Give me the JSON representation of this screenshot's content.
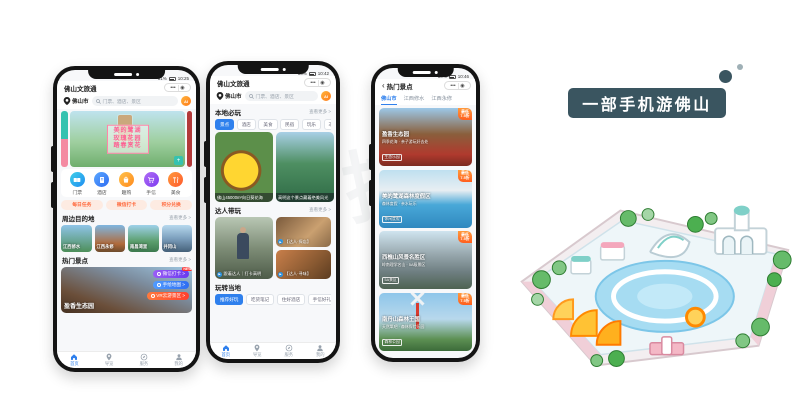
{
  "banner": {
    "title": "一部手机游佛山"
  },
  "watermark": "科技",
  "common": {
    "app_title": "佛山文旅通",
    "city": "佛山市",
    "search_placeholder": "门票、酒店、景区",
    "capsule_dots": "•••",
    "capsule_circle": "◉",
    "ai_label": "AI",
    "more_label": "查看更多 >"
  },
  "tabbar": {
    "items": [
      {
        "label": "首页"
      },
      {
        "label": "导览"
      },
      {
        "label": "服务"
      },
      {
        "label": "我的"
      }
    ]
  },
  "phone1": {
    "status_battery": "81%",
    "status_time": "10:25",
    "hero": {
      "line1": "美的鹭湖",
      "line2": "玫瑰花园",
      "line3": "踏春赏花",
      "plus": "+"
    },
    "quick_actions": [
      {
        "label": "门票"
      },
      {
        "label": "酒店"
      },
      {
        "label": "趣购"
      },
      {
        "label": "手信"
      },
      {
        "label": "美食"
      }
    ],
    "promos": [
      {
        "label": "每日任务"
      },
      {
        "label": "微信打卡"
      },
      {
        "label": "积分兑换"
      }
    ],
    "nearby": {
      "title": "周边目的地",
      "cards": [
        {
          "label": "江西修水"
        },
        {
          "label": "江西永修"
        },
        {
          "label": "南昌湾里"
        },
        {
          "label": "井冈山"
        }
      ]
    },
    "hot": {
      "title": "热门景点"
    },
    "feature": {
      "name": "盈香生态园",
      "badge1": "微信打卡 >",
      "badge1_tag": "NEW",
      "badge2": "手绘地图 >",
      "badge3": "VR云游景区 >"
    }
  },
  "phone2": {
    "status_battery": "80%",
    "status_time": "10:42",
    "must_play": {
      "title": "本地必玩",
      "chips": [
        {
          "label": "景点"
        },
        {
          "label": "酒店"
        },
        {
          "label": "美食"
        },
        {
          "label": "民宿"
        },
        {
          "label": "玩乐"
        },
        {
          "label": "非遗手作"
        }
      ],
      "card1_caption": "佛山45000m²向日葵花海",
      "card2_caption": "高明这个景点藏着绝美风光"
    },
    "daren": {
      "title": "达人带玩",
      "card1_caption": "跟着达人｜打卡高明",
      "card2_caption": "【达人·探店】",
      "card3_caption": "【达人·寻味】",
      "play": "▶"
    },
    "local": {
      "title": "玩转当地",
      "chips": [
        {
          "label": "推荐好玩"
        },
        {
          "label": "吃货笔记"
        },
        {
          "label": "住好酒店"
        },
        {
          "label": "手信好礼"
        }
      ]
    }
  },
  "phone3": {
    "status_battery": "80%",
    "status_time": "10:46",
    "back": "‹",
    "nav_title": "热门景点",
    "tabs": [
      {
        "label": "佛山市"
      },
      {
        "label": "江西修水"
      },
      {
        "label": "江西永修"
      }
    ],
    "badge_line1": "最低",
    "badge_line2": "7.5折",
    "cards": [
      {
        "name": "盈香生态园",
        "desc": "四季花海 · 亲子游玩好去处",
        "tag": "生态乐园"
      },
      {
        "name": "美的鹭湖森林度假区",
        "desc": "森林度假 · 亲水玩乐",
        "tag": "休闲度假"
      },
      {
        "name": "西樵山风景名胜区",
        "desc": "岭南理学名山 · 5A级景区",
        "tag": "5A景区"
      },
      {
        "name": "南丹山森林王国",
        "desc": "天然氧吧 · 森林探险乐园",
        "tag": "森林公园"
      }
    ]
  }
}
